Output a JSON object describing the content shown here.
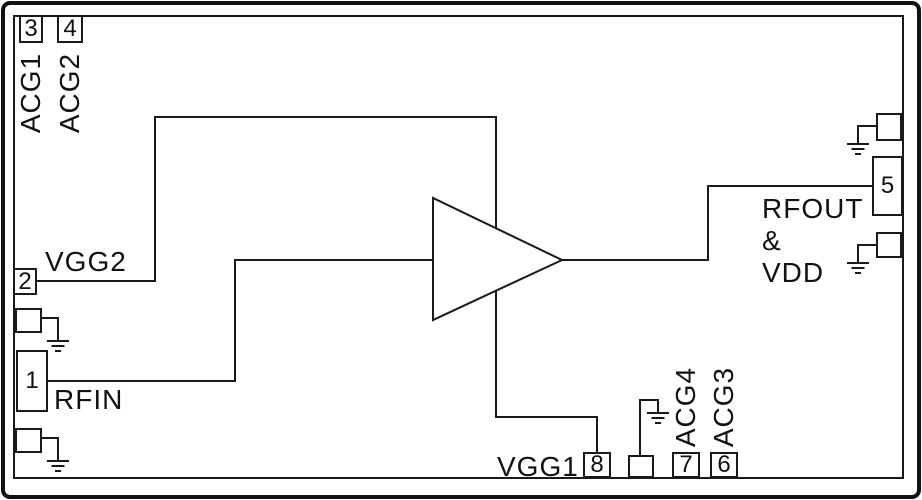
{
  "diagram_type": "ic-functional-block-diagram",
  "colors": {
    "line": "#1a1a1a",
    "background": "#ffffff",
    "text": "#111111"
  },
  "amplifier": {
    "symbol": "triangle-amplifier"
  },
  "pins": {
    "p1": {
      "number": "1",
      "label": "RFIN"
    },
    "p2": {
      "number": "2",
      "label": "VGG2"
    },
    "p3": {
      "number": "3",
      "label": "ACG1"
    },
    "p4": {
      "number": "4",
      "label": "ACG2"
    },
    "p5": {
      "number": "5",
      "label_line1": "RFOUT",
      "label_line2": "&",
      "label_line3": "VDD"
    },
    "p6": {
      "number": "6",
      "label": "ACG3"
    },
    "p7": {
      "number": "7",
      "label": "ACG4"
    },
    "p8": {
      "number": "8",
      "label": "VGG1"
    }
  }
}
